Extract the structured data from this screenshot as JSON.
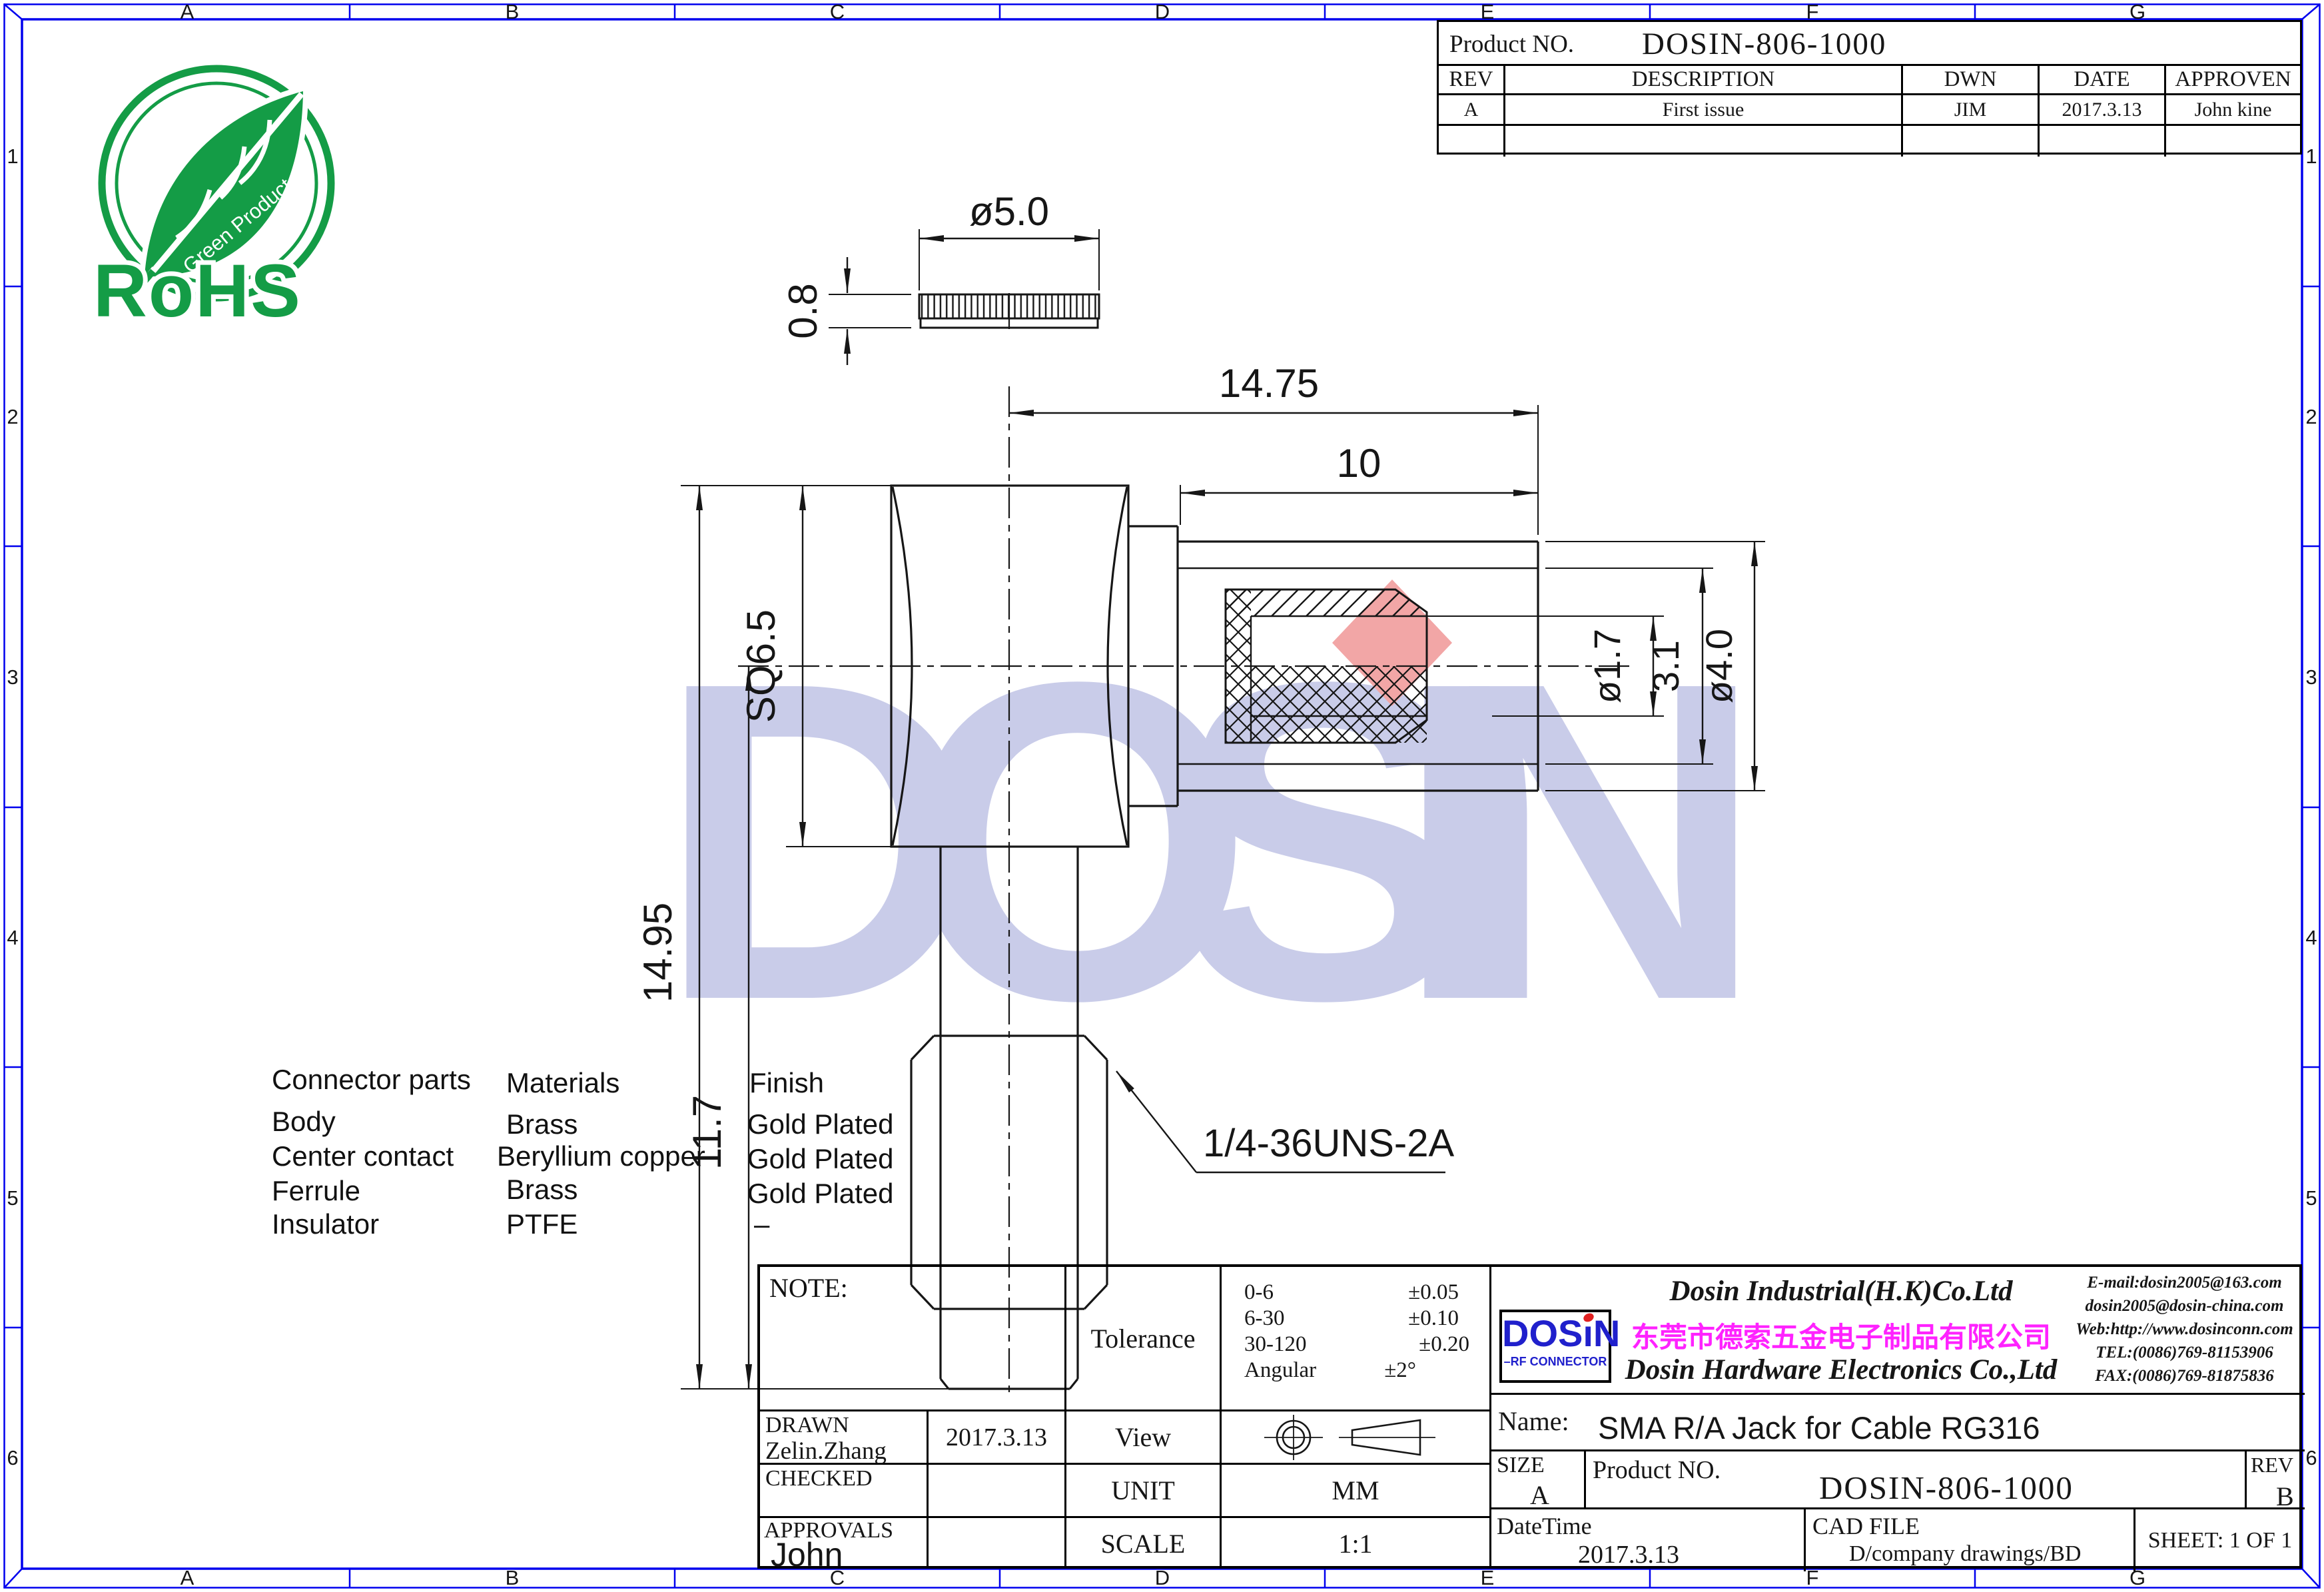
{
  "page": {
    "background": "#ffffff",
    "line_color": "#161616",
    "frame_color": "#0000ee"
  },
  "grid": {
    "top": [
      "A",
      "B",
      "C",
      "D",
      "E",
      "F",
      "G"
    ],
    "bottom": [
      "A",
      "B",
      "C",
      "D",
      "E",
      "F",
      "G"
    ],
    "left": [
      "1",
      "2",
      "3",
      "4",
      "5",
      "6"
    ],
    "right": [
      "1",
      "2",
      "3",
      "4",
      "5",
      "6"
    ]
  },
  "rohs": {
    "title": "RoHS",
    "subtitle": "Green Product",
    "color": "#149c46"
  },
  "watermark": {
    "text": "DOSIN",
    "color": "#c9cce9",
    "accent_color": "#f2a6a6"
  },
  "rev_table": {
    "product_no_label": "Product NO.",
    "product_no": "DOSIN-806-1000",
    "headers": [
      "REV",
      "DESCRIPTION",
      "DWN",
      "DATE",
      "APPROVEN"
    ],
    "rows": [
      [
        "A",
        "First issue",
        "JIM",
        "2017.3.13",
        "John kine"
      ],
      [
        "",
        "",
        "",
        "",
        ""
      ]
    ]
  },
  "dims": {
    "d50": "ø5.0",
    "d08": "0.8",
    "d1475": "14.75",
    "d10": "10",
    "sq65": "SQ6.5",
    "d1495": "14.95",
    "d117": "11.7",
    "d17": "ø1.7",
    "d31": "3.1",
    "d40": "ø4.0",
    "thread": "1/4-36UNS-2A"
  },
  "parts": {
    "headers": [
      "Connector parts",
      "Materials",
      "Finish"
    ],
    "rows": [
      [
        "Body",
        "Brass",
        "Gold Plated"
      ],
      [
        "Center contact",
        "Beryllium copper",
        "Gold Plated"
      ],
      [
        "Ferrule",
        "Brass",
        "Gold Plated"
      ],
      [
        "Insulator",
        "PTFE",
        "–"
      ]
    ]
  },
  "title_block": {
    "note_label": "NOTE:",
    "drawn_label": "DRAWN",
    "drawn_name": "Zelin.Zhang",
    "drawn_date": "2017.3.13",
    "checked_label": "CHECKED",
    "approvals_label": "APPROVALS",
    "approvals_name": "John",
    "tolerance_label": "Tolerance",
    "tolerance_rows": [
      [
        "0-6",
        "±0.05"
      ],
      [
        "6-30",
        "±0.10"
      ],
      [
        "30-120",
        "±0.20"
      ],
      [
        "Angular",
        "±2°"
      ]
    ],
    "view_label": "View",
    "unit_label": "UNIT",
    "unit_value": "MM",
    "scale_label": "SCALE",
    "scale_value": "1:1",
    "company": {
      "logo_left": "DOS",
      "logo_i": "ı",
      "logo_right": "N",
      "logo_sub": "–RF CONNECTOR",
      "logo_color": "#2020cc",
      "logo_dot_color": "#e02020",
      "name_en1": "Dosin Industrial(H.K)Co.Ltd",
      "name_cn": "东莞市德索五金电子制品有限公司",
      "cn_color": "#ff22ff",
      "name_en2": "Dosin Hardware Electronics  Co.,Ltd",
      "contact": [
        "E-mail:dosin2005@163.com",
        "dosin2005@dosin-china.com",
        "Web:http://www.dosinconn.com",
        "TEL:(0086)769-81153906",
        "FAX:(0086)769-81875836"
      ]
    },
    "name_label": "Name:",
    "name_value": "SMA R/A Jack for Cable RG316",
    "size_label": "SIZE",
    "size_value": "A",
    "product_no_label": "Product NO.",
    "product_no": "DOSIN-806-1000",
    "rev_label": "REV",
    "rev_value": "B",
    "datetime_label": "DateTime",
    "datetime_value": "2017.3.13",
    "cad_label": "CAD FILE",
    "cad_value": "D/company drawings/BD",
    "sheet": "SHEET: 1 OF 1"
  }
}
